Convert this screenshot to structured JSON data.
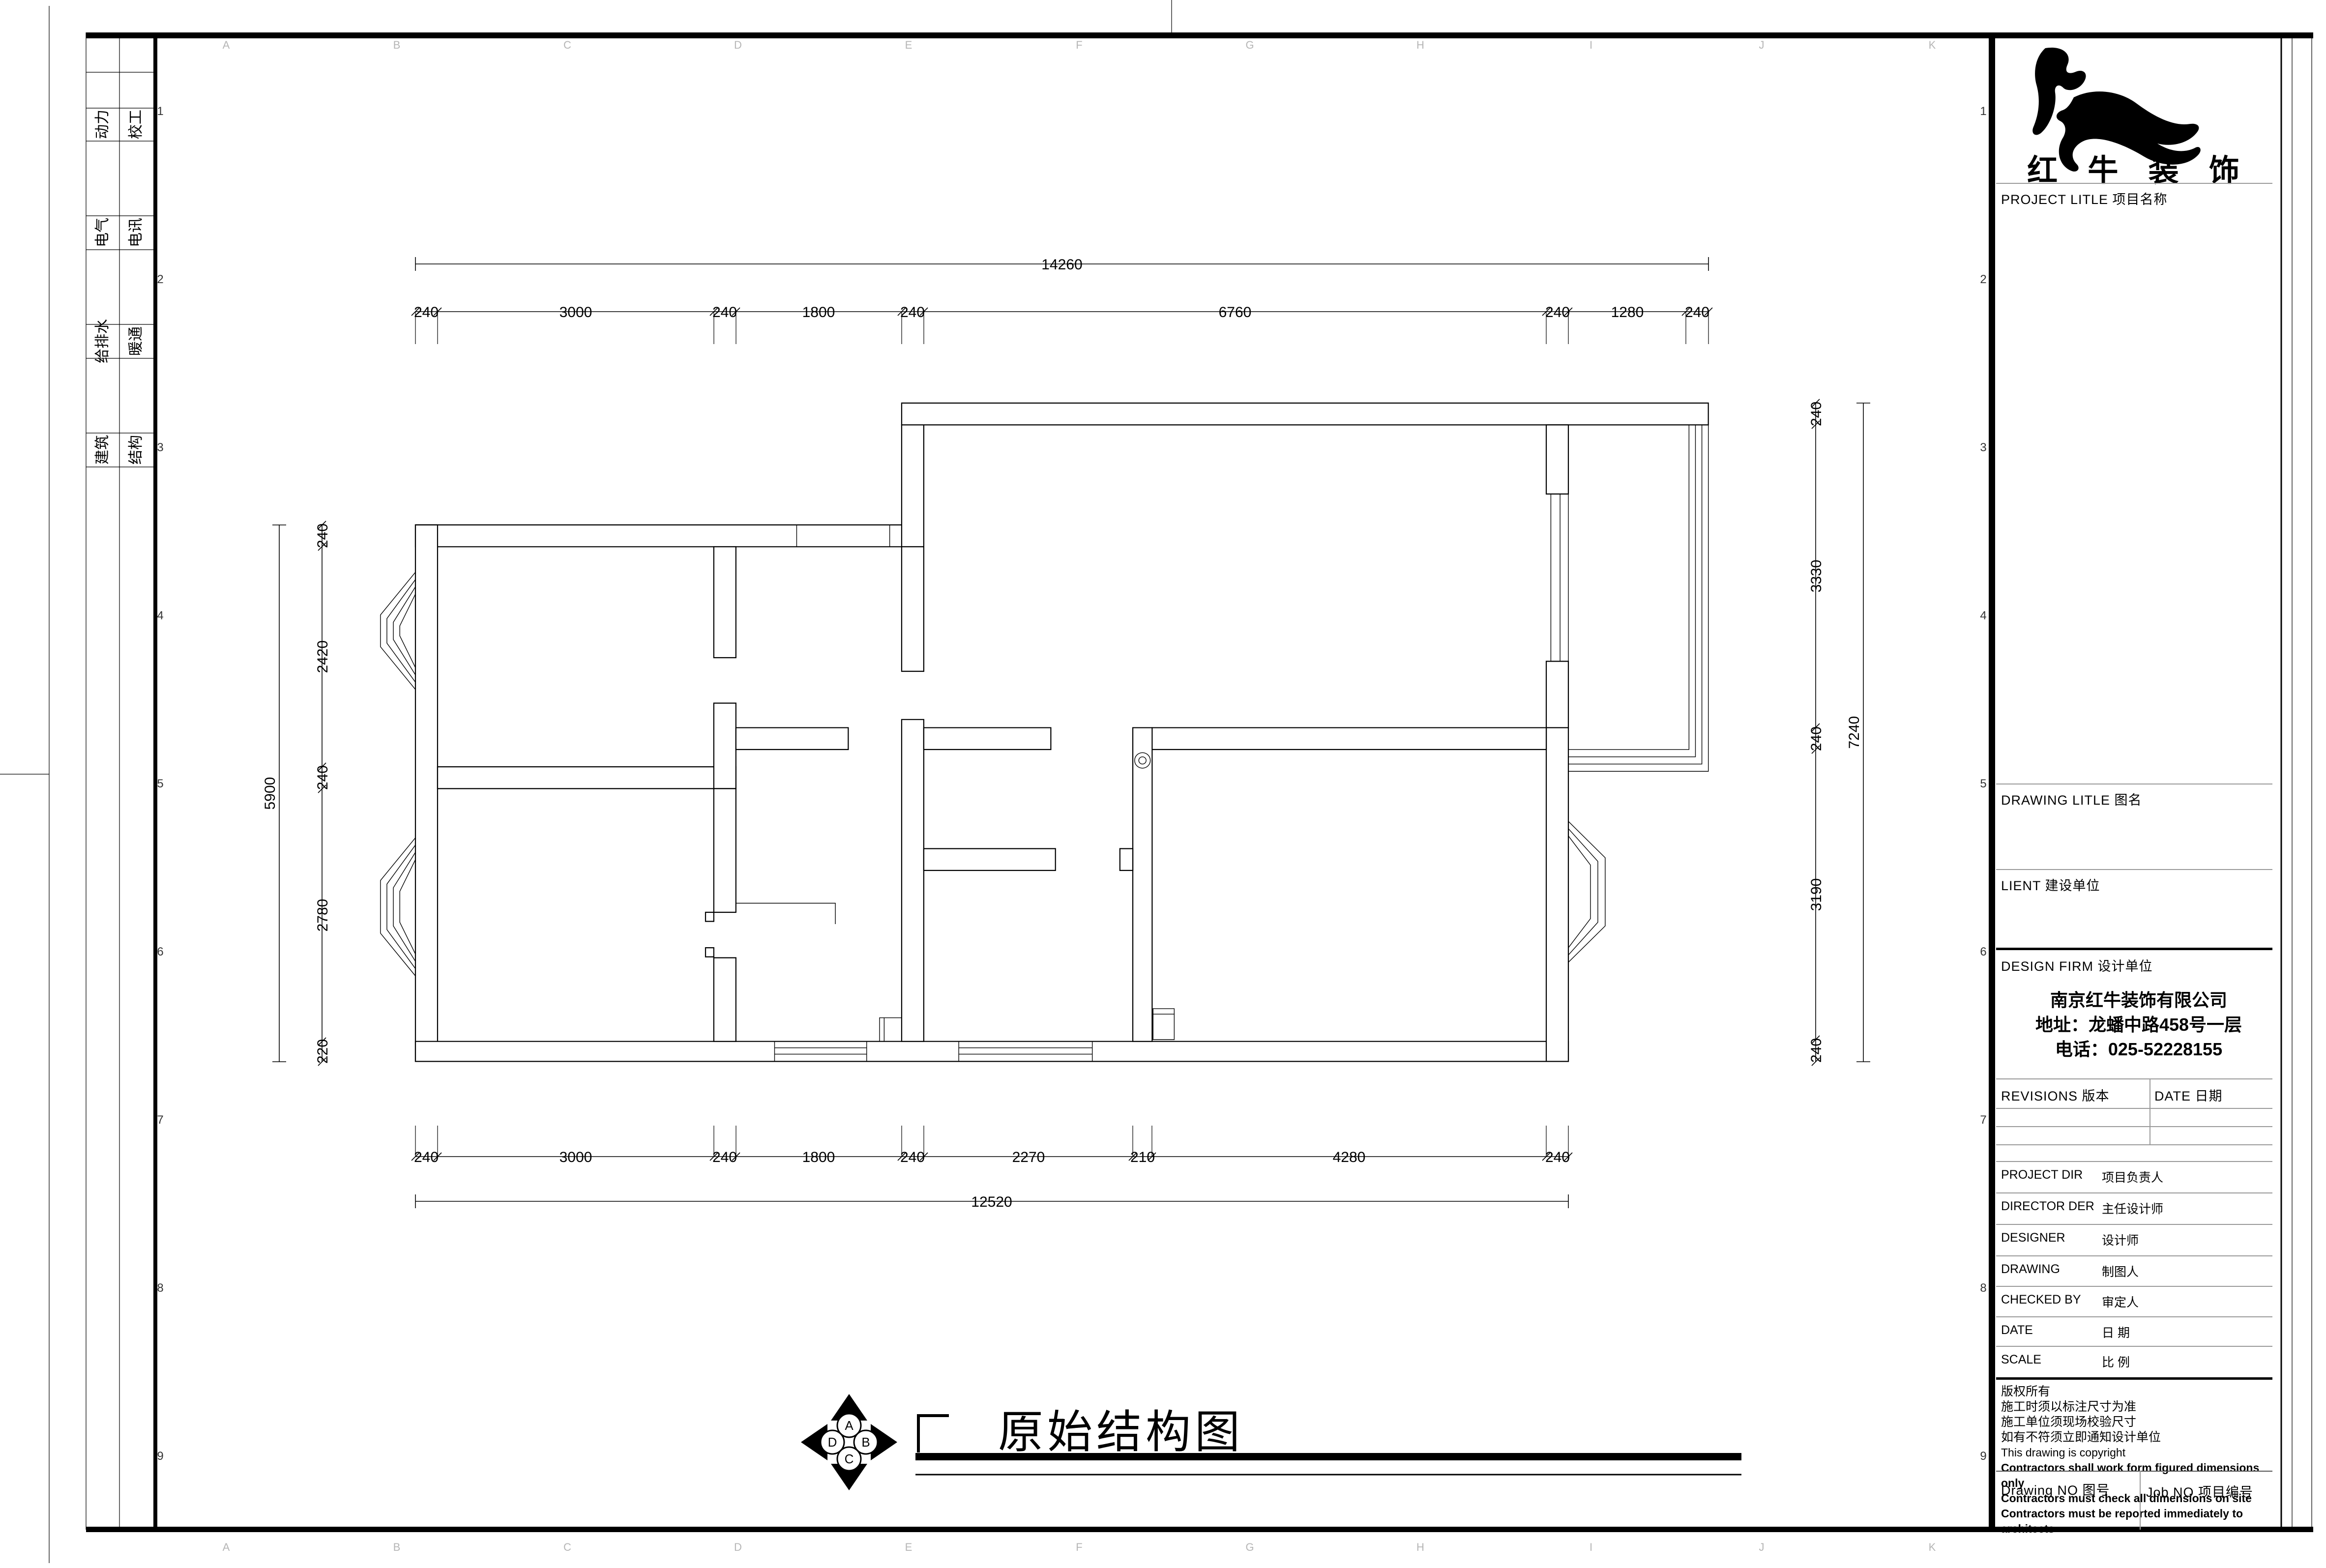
{
  "sheet": {
    "disciplines_col1": [
      "动力",
      "电气",
      "给排水",
      "建筑"
    ],
    "disciplines_col2": [
      "校工",
      "电讯",
      "暖通",
      "结构"
    ],
    "grid_letters": [
      "A",
      "B",
      "C",
      "D",
      "E",
      "F",
      "G",
      "H",
      "I",
      "J",
      "K"
    ],
    "grid_numbers": [
      "1",
      "2",
      "3",
      "4",
      "5",
      "6",
      "7",
      "8",
      "9"
    ],
    "colors": {
      "line": "#000000",
      "faint_grid": "#b5b5b5"
    }
  },
  "drawing": {
    "title": "原始结构图",
    "compass": {
      "top": "A",
      "right": "B",
      "bottom": "C",
      "left": "D"
    }
  },
  "dimensions": {
    "top_overall": "14260",
    "top_segments": [
      "240",
      "3000",
      "240",
      "1800",
      "240",
      "6760",
      "240",
      "1280",
      "240"
    ],
    "bottom_segments": [
      "240",
      "3000",
      "240",
      "1800",
      "240",
      "2270",
      "210",
      "4280",
      "240"
    ],
    "bottom_overall": "12520",
    "left_overall": "5900",
    "left_segments": [
      "240",
      "2420",
      "240",
      "2780",
      "220"
    ],
    "right_segments": [
      "240",
      "3330",
      "240",
      "3190",
      "240"
    ],
    "right_overall": "7240"
  },
  "title_block": {
    "brand": "红 牛 装 饰",
    "project_label": "PROJECT LITLE  项目名称",
    "drawing_label": "DRAWING LITLE  图名",
    "client_label": "LIENT  建设单位",
    "design_firm_label": "DESIGN FIRM  设计单位",
    "company": "南京红牛装饰有限公司",
    "address": "地址：龙蟠中路458号一层",
    "phone": "电话：025-52228155",
    "revisions_label": "REVISIONS  版本",
    "date_col_label": "DATE  日期",
    "rows": [
      {
        "en": "PROJECT DIR",
        "zh": "项目负责人"
      },
      {
        "en": "DIRECTOR DER",
        "zh": "主任设计师"
      },
      {
        "en": "DESIGNER",
        "zh": "设计师"
      },
      {
        "en": "DRAWING",
        "zh": "制图人"
      },
      {
        "en": "CHECKED BY",
        "zh": "审定人"
      },
      {
        "en": "DATE",
        "zh": "日  期"
      },
      {
        "en": "SCALE",
        "zh": "比  例"
      }
    ],
    "copyright_lines": [
      "版权所有",
      "施工时须以标注尺寸为准",
      "施工单位须现场校验尺寸",
      "如有不符须立即通知设计单位",
      "This drawing is copyright",
      "Contractors shall work form figured dimensions only",
      "Contractors must check all dimensions on site",
      "Contractors must be reported immediately to architects"
    ],
    "drawing_no_label": "Drawing NO  图号",
    "job_no_label": "Job NO  项目编号"
  }
}
